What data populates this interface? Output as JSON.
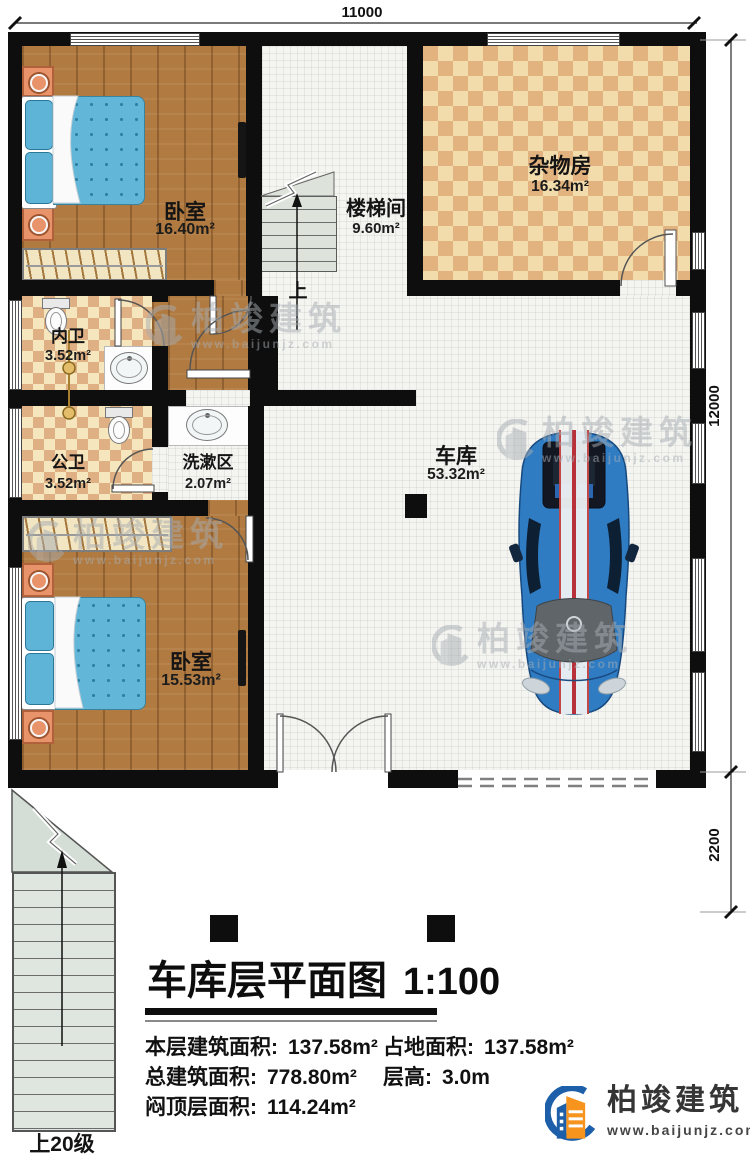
{
  "plan": {
    "dim_top": "11000",
    "dim_right_upper": "12000",
    "dim_right_lower": "2200",
    "up_label": "上",
    "exterior_stairs_label": "上20级",
    "rooms": {
      "bedroom1": {
        "name": "卧室",
        "area": "16.40m²"
      },
      "stairwell": {
        "name": "楼梯间",
        "area": "9.60m²"
      },
      "storage": {
        "name": "杂物房",
        "area": "16.34m²"
      },
      "bath_inner": {
        "name": "内卫",
        "area": "3.52m²"
      },
      "bath_public": {
        "name": "公卫",
        "area": "3.52m²"
      },
      "wash": {
        "name": "洗漱区",
        "area": "2.07m²"
      },
      "garage": {
        "name": "车库",
        "area": "53.32m²"
      },
      "bedroom2": {
        "name": "卧室",
        "area": "15.53m²"
      }
    }
  },
  "footer": {
    "title": "车库层平面图",
    "scale": "1:100",
    "stats_col1": [
      {
        "label": "本层建筑面积:",
        "value": "137.58m²"
      },
      {
        "label": "总建筑面积:",
        "value": "778.80m²"
      },
      {
        "label": "闷顶层面积:",
        "value": "114.24m²"
      }
    ],
    "stats_col2": [
      {
        "label": "占地面积:",
        "value": "137.58m²"
      },
      {
        "label": "层高:",
        "value": "3.0m"
      }
    ]
  },
  "brand": {
    "name": "柏竣建筑",
    "url": "www.baijunjz.com",
    "color_blue": "#1d5fa8",
    "color_orange": "#f7941d"
  }
}
